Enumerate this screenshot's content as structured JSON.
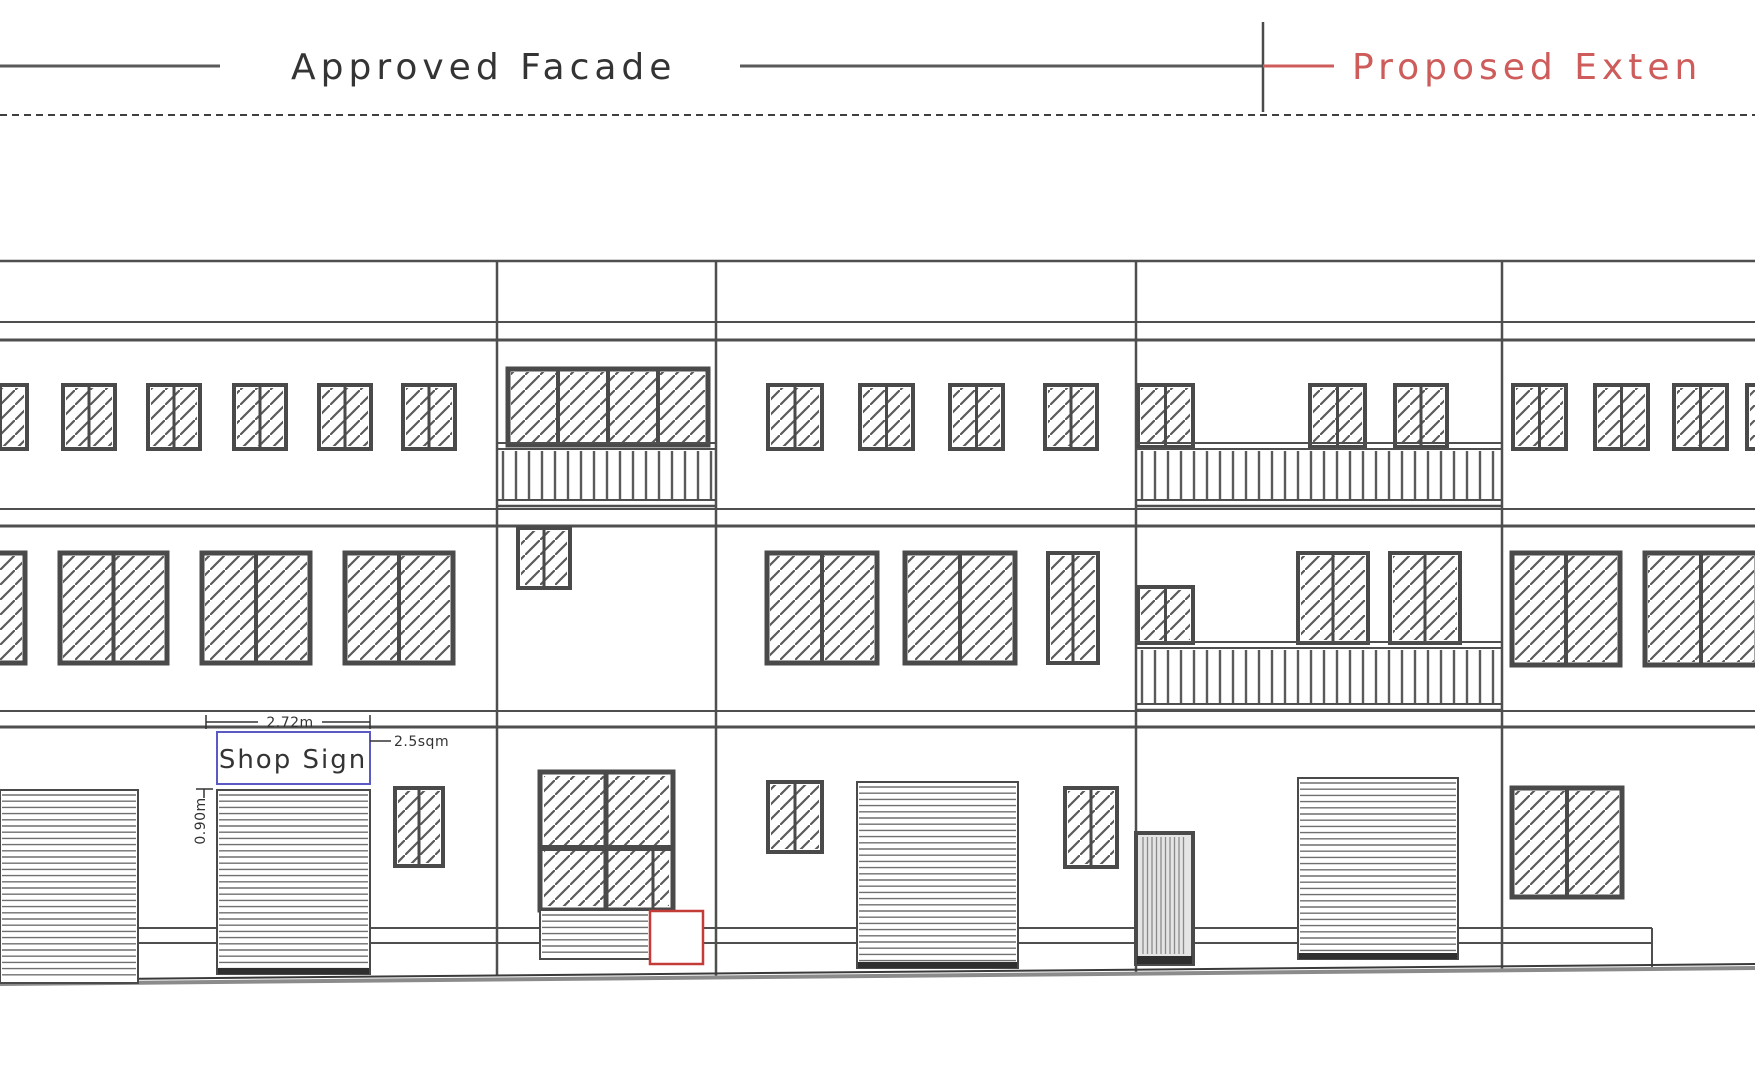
{
  "legend": {
    "approved_label": "Approved Facade",
    "proposed_label": "Proposed Exten",
    "y": 66,
    "left_line": [
      0,
      220
    ],
    "mid_line": [
      740,
      1263
    ],
    "divider_x": 1263,
    "divider_y": [
      22,
      112
    ],
    "red_line": [
      1263,
      1334
    ],
    "approved_text_x": 291,
    "proposed_text_x": 1352
  },
  "annotations": {
    "sign_label": "Shop Sign",
    "sign_width": "2.72m",
    "sign_area": "2.5sqm",
    "sign_height": "0.90m"
  },
  "colors": {
    "line": "#4f4f4f",
    "line_light": "#6e6e6e",
    "frame": "#4a4a4a",
    "hatch": "#5a5a5a",
    "slat": "#6f6f6f",
    "red": "#cd5c5a",
    "red_box": "#c43c38",
    "blue": "#5a5ac2",
    "ink": "#333333",
    "ink_dark": "#343434",
    "ground": "#8b8b8b"
  },
  "drawing": {
    "width": 1755,
    "height": 1080,
    "dashed_line_y": 115,
    "hlines": [
      {
        "y": 261,
        "w": 2.5
      },
      {
        "y": 322,
        "w": 2
      },
      {
        "y": 340,
        "w": 3
      },
      {
        "y": 509,
        "w": 2
      },
      {
        "y": 526,
        "w": 3
      },
      {
        "y": 711,
        "w": 2
      },
      {
        "y": 727,
        "w": 3
      }
    ],
    "vlines": [
      {
        "x": 497,
        "y1": 261,
        "y2": 976
      },
      {
        "x": 716,
        "y1": 261,
        "y2": 976
      },
      {
        "x": 1136,
        "y1": 261,
        "y2": 974
      },
      {
        "x": 1502,
        "y1": 261,
        "y2": 970
      }
    ],
    "plinth": {
      "ys": [
        928,
        943
      ],
      "x1": 138,
      "x2": 1652
    },
    "corner": {
      "x": 1652,
      "y1": 928,
      "y2": 969
    },
    "ground_lines": [
      {
        "x1": 0,
        "y1": 980,
        "x2": 1755,
        "y2": 964,
        "w": 2,
        "dark": true
      },
      {
        "x1": 0,
        "y1": 984,
        "x2": 1755,
        "y2": 968,
        "w": 4,
        "dark": false
      }
    ],
    "windows": [
      {
        "x": -26,
        "y": 385,
        "w": 53,
        "h": 64,
        "panes": 2,
        "fw": 4
      },
      {
        "x": 63,
        "y": 385,
        "w": 52,
        "h": 64,
        "panes": 2,
        "fw": 4
      },
      {
        "x": 148,
        "y": 385,
        "w": 52,
        "h": 64,
        "panes": 2,
        "fw": 4
      },
      {
        "x": 234,
        "y": 385,
        "w": 52,
        "h": 64,
        "panes": 2,
        "fw": 4
      },
      {
        "x": 319,
        "y": 385,
        "w": 52,
        "h": 64,
        "panes": 2,
        "fw": 4
      },
      {
        "x": 403,
        "y": 385,
        "w": 52,
        "h": 64,
        "panes": 2,
        "fw": 4
      },
      {
        "x": 768,
        "y": 385,
        "w": 54,
        "h": 64,
        "panes": 2,
        "fw": 4
      },
      {
        "x": 860,
        "y": 385,
        "w": 53,
        "h": 64,
        "panes": 2,
        "fw": 4
      },
      {
        "x": 950,
        "y": 385,
        "w": 53,
        "h": 64,
        "panes": 2,
        "fw": 4
      },
      {
        "x": 1045,
        "y": 385,
        "w": 52,
        "h": 64,
        "panes": 2,
        "fw": 4
      },
      {
        "x": 1138,
        "y": 385,
        "w": 55,
        "h": 62,
        "panes": 2,
        "fw": 4
      },
      {
        "x": 1310,
        "y": 385,
        "w": 55,
        "h": 62,
        "panes": 2,
        "fw": 4
      },
      {
        "x": 1395,
        "y": 385,
        "w": 52,
        "h": 62,
        "panes": 2,
        "fw": 4
      },
      {
        "x": 1513,
        "y": 385,
        "w": 53,
        "h": 64,
        "panes": 2,
        "fw": 4
      },
      {
        "x": 1595,
        "y": 385,
        "w": 53,
        "h": 64,
        "panes": 2,
        "fw": 4
      },
      {
        "x": 1674,
        "y": 385,
        "w": 53,
        "h": 64,
        "panes": 2,
        "fw": 4
      },
      {
        "x": 1747,
        "y": 385,
        "w": 53,
        "h": 64,
        "panes": 2,
        "fw": 4
      },
      {
        "x": 508,
        "y": 369,
        "w": 200,
        "h": 76,
        "panes": 4,
        "fw": 5
      },
      {
        "x": -50,
        "y": 553,
        "w": 75,
        "h": 110,
        "panes": 1,
        "fw": 5
      },
      {
        "x": 60,
        "y": 553,
        "w": 107,
        "h": 110,
        "panes": 2,
        "fw": 5
      },
      {
        "x": 202,
        "y": 553,
        "w": 108,
        "h": 110,
        "panes": 2,
        "fw": 5
      },
      {
        "x": 345,
        "y": 553,
        "w": 108,
        "h": 110,
        "panes": 2,
        "fw": 5
      },
      {
        "x": 767,
        "y": 553,
        "w": 110,
        "h": 110,
        "panes": 2,
        "fw": 5
      },
      {
        "x": 905,
        "y": 553,
        "w": 110,
        "h": 110,
        "panes": 2,
        "fw": 5
      },
      {
        "x": 1048,
        "y": 553,
        "w": 50,
        "h": 110,
        "panes": 2,
        "fw": 4
      },
      {
        "x": 518,
        "y": 528,
        "w": 52,
        "h": 60,
        "panes": 2,
        "fw": 4
      },
      {
        "x": 1298,
        "y": 553,
        "w": 70,
        "h": 90,
        "panes": 2,
        "fw": 4
      },
      {
        "x": 1390,
        "y": 553,
        "w": 70,
        "h": 90,
        "panes": 2,
        "fw": 4
      },
      {
        "x": 1138,
        "y": 587,
        "w": 55,
        "h": 56,
        "panes": 2,
        "fw": 4
      },
      {
        "x": 1512,
        "y": 553,
        "w": 108,
        "h": 112,
        "panes": 2,
        "fw": 5
      },
      {
        "x": 1645,
        "y": 553,
        "w": 112,
        "h": 112,
        "panes": 2,
        "fw": 5
      },
      {
        "x": 395,
        "y": 788,
        "w": 48,
        "h": 78,
        "panes": 2,
        "fw": 4
      },
      {
        "x": 768,
        "y": 782,
        "w": 54,
        "h": 70,
        "panes": 2,
        "fw": 4
      },
      {
        "x": 1065,
        "y": 788,
        "w": 52,
        "h": 79,
        "panes": 2,
        "fw": 4
      },
      {
        "x": 1512,
        "y": 788,
        "w": 110,
        "h": 109,
        "panes": 2,
        "fw": 5
      }
    ],
    "shutters": [
      {
        "x": 0,
        "y": 790,
        "w": 138,
        "h": 193,
        "bar": false
      },
      {
        "x": 217,
        "y": 790,
        "w": 153,
        "h": 184,
        "bar": true
      },
      {
        "x": 857,
        "y": 782,
        "w": 161,
        "h": 186,
        "bar": true
      },
      {
        "x": 1298,
        "y": 778,
        "w": 160,
        "h": 181,
        "bar": true
      }
    ],
    "door": {
      "x": 1136,
      "y": 833,
      "w": 57,
      "h": 131
    },
    "shopfront": {
      "x": 540,
      "y": 772,
      "w": 133,
      "h": 138,
      "mullion_x": 606,
      "transom_y": 848,
      "jamb_x": 653,
      "shutter": {
        "x": 540,
        "y": 910,
        "w": 110,
        "h": 49,
        "bar": false
      }
    },
    "red_box": {
      "x": 650,
      "y": 911,
      "w": 53,
      "h": 53
    },
    "balconies": [
      {
        "x1": 497,
        "x2": 716,
        "rail": [
          443,
          449
        ],
        "slats": [
          451,
          500
        ],
        "bottom": [
          500,
          506
        ],
        "pitch": 13
      },
      {
        "x1": 1136,
        "x2": 1502,
        "rail": [
          443,
          449
        ],
        "slats": [
          451,
          500
        ],
        "bottom": [
          500,
          506
        ],
        "pitch": 13
      },
      {
        "x1": 1136,
        "x2": 1502,
        "rail": [
          642,
          648
        ],
        "slats": [
          650,
          704
        ],
        "bottom": [
          704,
          710
        ],
        "pitch": 13
      }
    ],
    "sign_box": {
      "x": 217,
      "y": 732,
      "w": 153,
      "h": 52
    },
    "dim_width": {
      "line_y": 722,
      "segs": [
        [
          206,
          258
        ],
        [
          322,
          370
        ]
      ],
      "tick_xs": [
        206,
        370
      ],
      "tick_y": [
        715,
        729
      ]
    },
    "dim_area_leader": {
      "x1": 370,
      "y1": 741,
      "x2": 391,
      "y2": 741
    },
    "dim_height": {
      "tick": [
        196,
        789,
        213,
        789
      ],
      "stub": [
        204,
        789,
        204,
        798
      ]
    }
  }
}
